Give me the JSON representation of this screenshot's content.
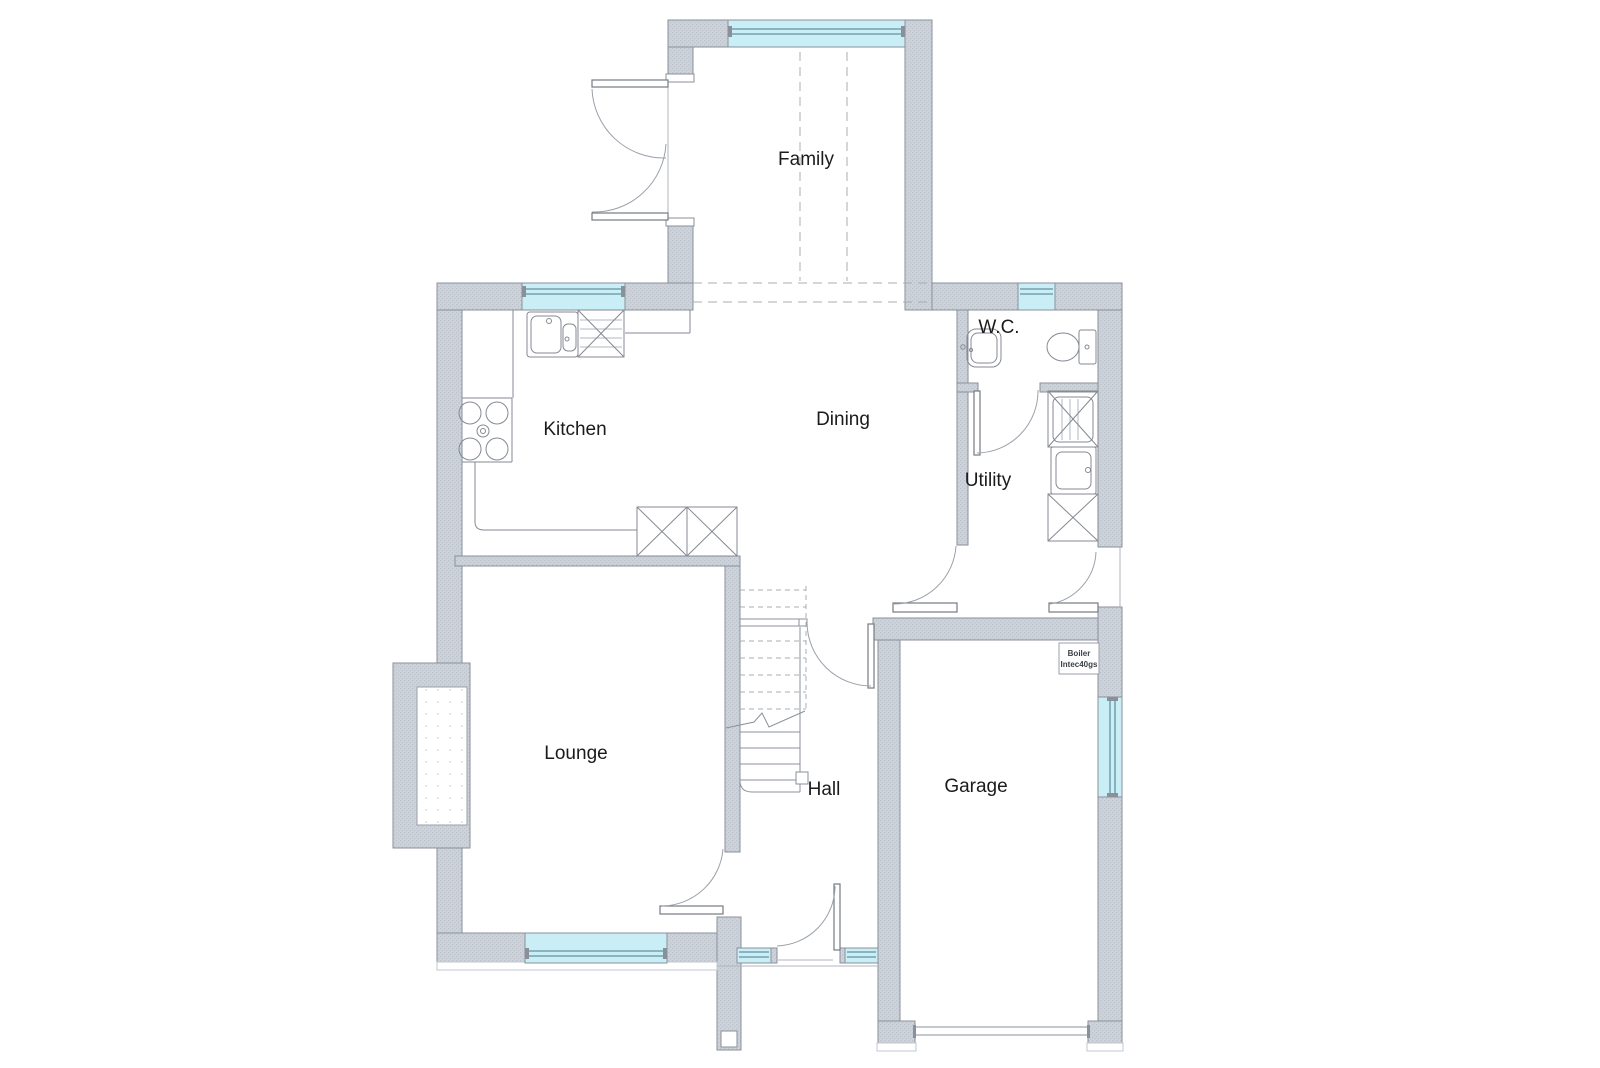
{
  "document": {
    "type": "floor-plan",
    "background": "#ffffff"
  },
  "colors": {
    "wall_fill": "#ced3da",
    "wall_stipple": "#bdc3cd",
    "wall_stroke": "#8a909a",
    "window_glass": "#c9eef6",
    "window_frame": "#64929f",
    "line": "#8b9199",
    "text": "#1b1b1b"
  },
  "rooms": {
    "family": {
      "label": "Family"
    },
    "kitchen": {
      "label": "Kitchen"
    },
    "dining": {
      "label": "Dining"
    },
    "wc": {
      "label": "W.C."
    },
    "utility": {
      "label": "Utility"
    },
    "lounge": {
      "label": "Lounge"
    },
    "hall": {
      "label": "Hall"
    },
    "garage": {
      "label": "Garage"
    }
  },
  "annotations": {
    "boiler": {
      "line1": "Boiler",
      "line2": "Intec40gs"
    }
  },
  "fixtures": [
    "kitchen-sink",
    "kitchen-appliance",
    "hob",
    "kitchen-base-units",
    "utility-appliance-top",
    "utility-sink",
    "utility-appliance-bottom",
    "wc-basin",
    "wc-toilet",
    "staircase",
    "fireplace-chimney",
    "french-doors",
    "front-door",
    "garage-door",
    "boiler"
  ]
}
